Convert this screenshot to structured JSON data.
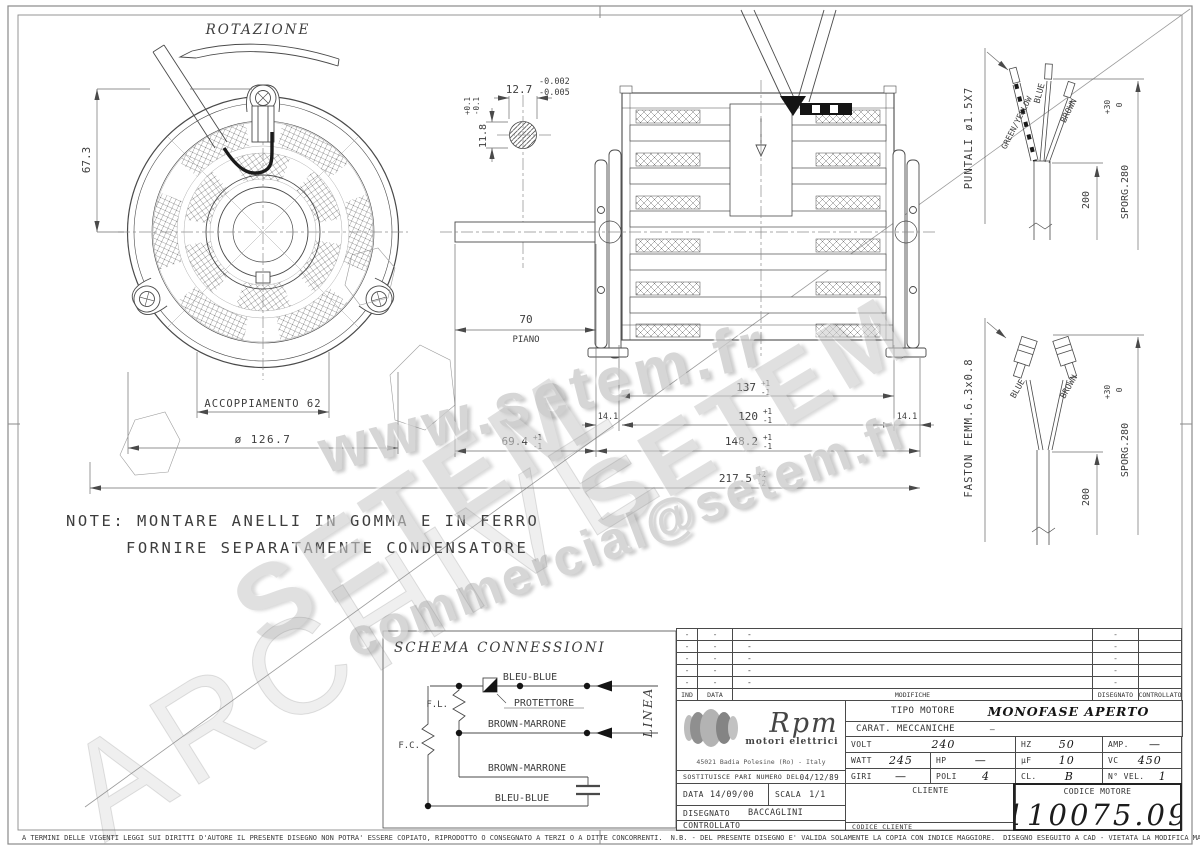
{
  "watermarks": {
    "www": "www.setem.fr",
    "setem_a": "SETEM",
    "setem_b": "SETEM",
    "email": "commercial@setem.fr",
    "archive": "ARCHIVE"
  },
  "front_view": {
    "rotation_label": "ROTAZIONE",
    "dim_height": "67.3",
    "dim_coupling": "ACCOPPIAMENTO 62",
    "dim_diameter": "ø 126.7"
  },
  "shaft_detail": {
    "dim_width": "12.7",
    "tol_w_upper": "-0.002",
    "tol_w_lower": "-0.005",
    "dim_height": "11.8",
    "tol_h_upper": "+0.1",
    "tol_h_lower": "-0.1"
  },
  "side_view": {
    "dim_flat": "70",
    "flat_label": "PIANO",
    "dim_stack": "137",
    "dim_ring_left": "14.1",
    "dim_core": "120",
    "dim_ring_right": "14.1",
    "dim_shaft_ext": "69.4",
    "dim_body": "148.2",
    "dim_total": "217.5",
    "tol_p1": "+1",
    "tol_m1": "-1",
    "tol_p2": "+2",
    "tol_m2": "-2"
  },
  "puntali": {
    "label": "PUNTALI ø1.5X7",
    "wire_gy": "GREEN/YELLOW",
    "wire_blue": "BLUE",
    "wire_brown": "BROWN",
    "dim_len": "200",
    "dim_sporg": "SPORG.280",
    "tol_plus": "+30",
    "tol_zero": "0"
  },
  "faston": {
    "label": "FASTON FEMM.6.3x0.8",
    "wire_blue": "BLUE",
    "wire_brown": "BROWN",
    "dim_len": "200",
    "dim_sporg": "SPORG.280",
    "tol_plus": "+30",
    "tol_zero": "0"
  },
  "note": {
    "line1": "NOTE: MONTARE ANELLI IN GOMMA E IN FERRO",
    "line2": "FORNIRE SEPARATAMENTE CONDENSATORE"
  },
  "schema": {
    "title": "SCHEMA CONNESSIONI",
    "bleu_top": "BLEU-BLUE",
    "protettore": "PROTETTORE",
    "fl": "F.L.",
    "fc": "F.C.",
    "brown_mid": "BROWN-MARRONE",
    "brown_low": "BROWN-MARRONE",
    "bleu_bottom": "BLEU-BLUE",
    "linea": "LINEA"
  },
  "title_block": {
    "dash": "-",
    "rev": {
      "ind": "IND",
      "data": "DATA",
      "modifiche": "MODIFICHE",
      "disegnato": "DISEGNATO",
      "controllato": "CONTROLLATO"
    },
    "logo": {
      "name": "Rpm",
      "subtitle": "motori elettrici",
      "address": "45021 Badia Polesine (Ro) - Italy"
    },
    "tipo_label": "TIPO MOTORE",
    "tipo_value": "MONOFASE APERTO",
    "carat_label": "CARAT. MECCANICHE",
    "carat_value": "—",
    "volt_label": "VOLT",
    "volt": "240",
    "hz_label": "HZ",
    "hz": "50",
    "amp_label": "AMP.",
    "amp": "—",
    "watt_label": "WATT",
    "watt": "245",
    "hp_label": "HP",
    "hp": "—",
    "uf_label": "µF",
    "uf": "10",
    "vc_label": "VC",
    "vc": "450",
    "giri_label": "GIRI",
    "giri": "—",
    "poli_label": "POLI",
    "poli": "4",
    "cl_label": "CL.",
    "cl": "B",
    "nvel_label": "N° VEL.",
    "nvel": "1",
    "sostituisce_label": "SOSTITUISCE PARI NUMERO DEL",
    "sostituisce_date": "04/12/89",
    "data_label": "DATA",
    "data_value": "14/09/00",
    "scala_label": "SCALA",
    "scala_value": "1/1",
    "disegnato_label": "DISEGNATO",
    "disegnato_value": "BACCAGLINI",
    "controllato_label": "CONTROLLATO",
    "cliente_label": "CLIENTE",
    "codice_cliente_label": "CODICE CLIENTE",
    "codice_motore_label": "CODICE MOTORE",
    "codice_motore": "110075.09"
  },
  "footer": {
    "copyright": "A TERMINI DELLE VIGENTI LEGGI SUI DIRITTI D'AUTORE IL PRESENTE DISEGNO NON POTRA' ESSERE COPIATO, RIPRODOTTO O CONSEGNATO A TERZI O A DITTE CONCORRENTI.",
    "nb": "N.B. - DEL PRESENTE DISEGNO E' VALIDA SOLAMENTE LA COPIA CON INDICE MAGGIORE.",
    "cad": "DISEGNO ESEGUITO A CAD - VIETATA LA MODIFICA MANUALE"
  }
}
